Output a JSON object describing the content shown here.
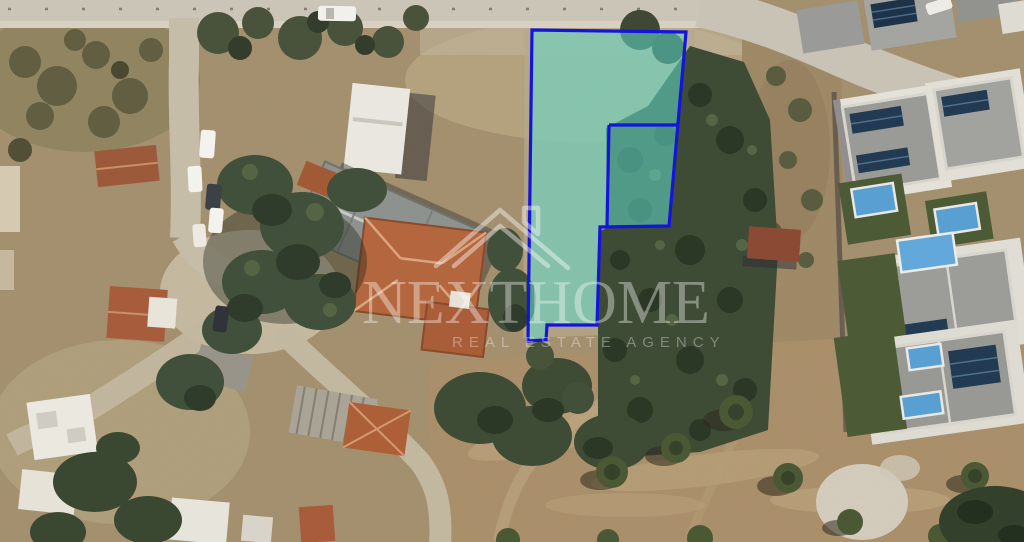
{
  "window": {
    "width_px": 1024,
    "height_px": 542
  },
  "map": {
    "kind": "satellite-aerial-photo",
    "scene_description": "Aerial satellite view of a residential neighbourhood with dirt roads, houses, villas with pools, trees and an open field"
  },
  "parcel": {
    "outline_points": "532,30 686,32 669,226 600,227 597,325 547,325 546,340 528,341",
    "subdivision_lines": [
      "609,125 678,125",
      "609,125 607,226"
    ],
    "stroke_color": "#1414dc",
    "stroke_width": "3.2",
    "fill_color": "#52d8c6",
    "fill_opacity": "0.5"
  },
  "watermark": {
    "brand": "NEXTHOME",
    "subtitle": "REAL ESTATE AGENCY",
    "color": "#ffffff"
  }
}
